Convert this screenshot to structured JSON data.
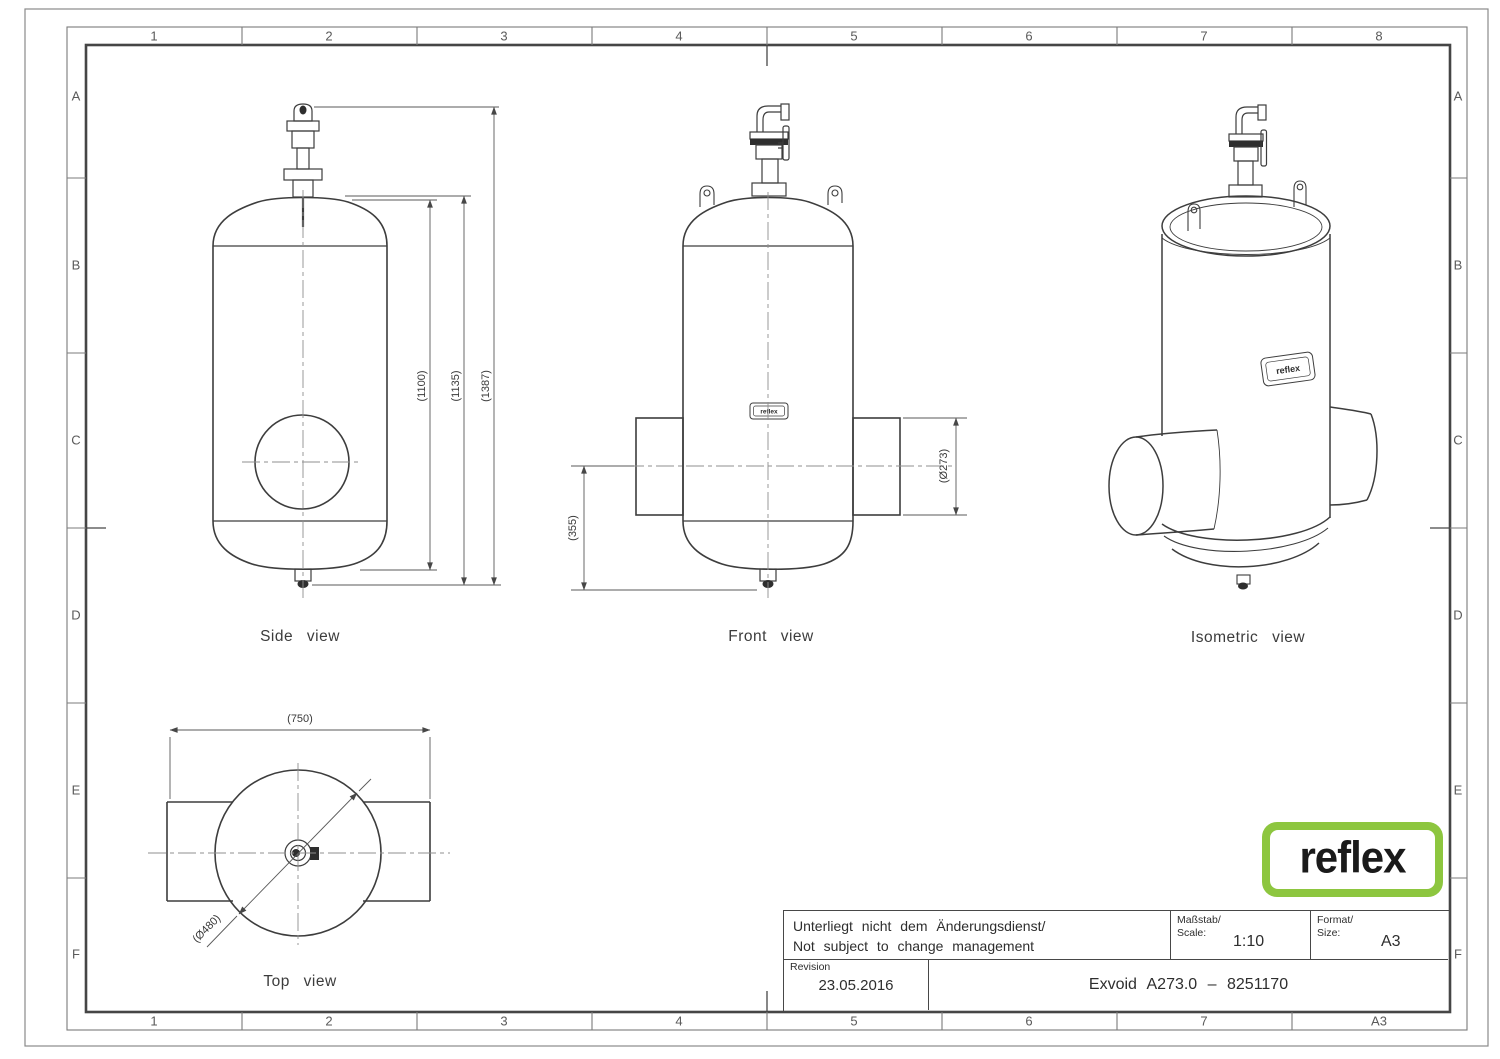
{
  "sheet": {
    "grid": {
      "top_cols": [
        "1",
        "2",
        "3",
        "4",
        "5",
        "6",
        "7",
        "8"
      ],
      "bottom_cols": [
        "1",
        "2",
        "3",
        "4",
        "5",
        "6",
        "7",
        "A3"
      ],
      "left_rows": [
        "A",
        "B",
        "C",
        "D",
        "E",
        "F"
      ],
      "right_rows": [
        "A",
        "B",
        "C",
        "D",
        "E",
        "F"
      ]
    },
    "views": {
      "side": {
        "caption": "Side view",
        "dim_height_1100": "(1100)",
        "dim_height_1135": "(1135)",
        "dim_height_1387": "(1387)"
      },
      "front": {
        "caption": "Front view",
        "dim_bottom_355": "(355)",
        "dim_pipe_273": "(Ø273)"
      },
      "isometric": {
        "caption": "Isometric view"
      },
      "top": {
        "caption": "Top view",
        "dim_width_750": "(750)",
        "dim_diameter_480": "(Ø480)"
      }
    },
    "nameplate_text": "reflex",
    "logo": {
      "text": "reflex",
      "color": "#8DC63F"
    },
    "title_block": {
      "change_note_de": "Unterliegt nicht dem Änderungsdienst/",
      "change_note_en": "Not subject to change management",
      "scale_label_de": "Maßstab/",
      "scale_label_en": "Scale:",
      "scale_value": "1:10",
      "format_label_de": "Format/",
      "format_label_en": "Size:",
      "format_value": "A3",
      "revision_label": "Revision",
      "revision_date": "23.05.2016",
      "part_title": "Exvoid A273.0 – 8251170"
    }
  }
}
